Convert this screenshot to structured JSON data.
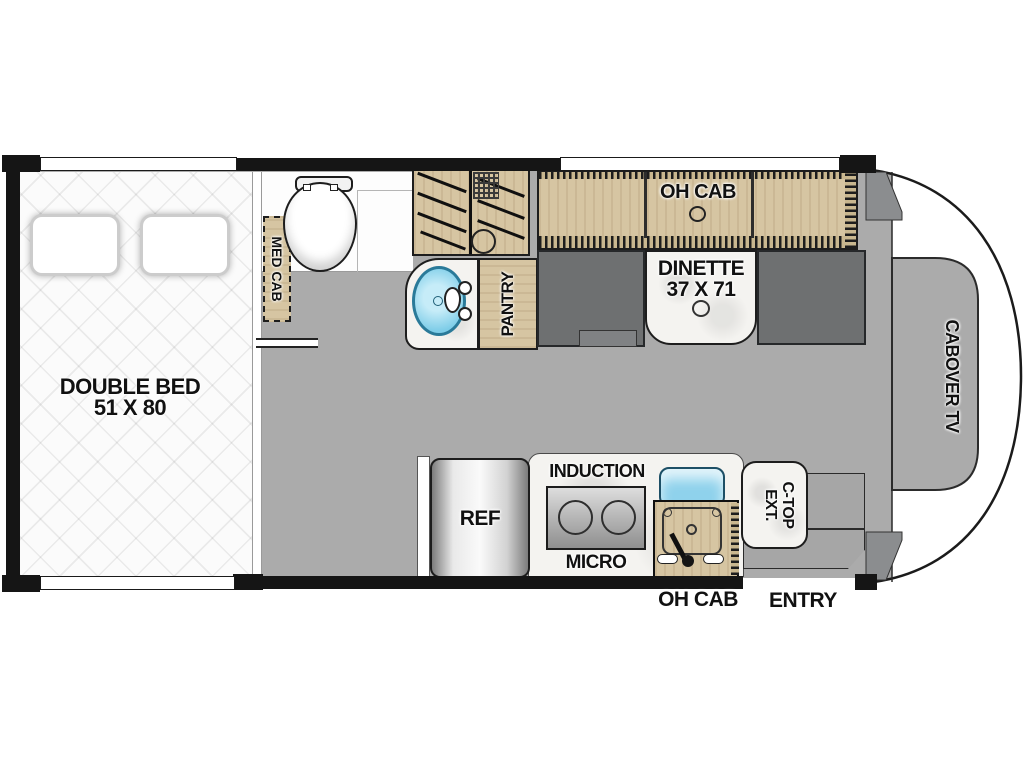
{
  "labels": {
    "double_bed_line1": "DOUBLE BED",
    "double_bed_line2": "51 X 80",
    "med_cab": "MED CAB",
    "pantry": "PANTRY",
    "oh_cab_top": "OH CAB",
    "dinette_line1": "DINETTE",
    "dinette_line2": "37 X 71",
    "cabover_tv": "CABOVER TV",
    "ref": "REF",
    "induction": "INDUCTION",
    "micro": "MICRO",
    "oh_cab_bottom": "OH CAB",
    "ctop_line1": "C-TOP",
    "ctop_line2": "EXT.",
    "entry": "ENTRY"
  },
  "colors": {
    "wall": "#151515",
    "floor": "#ababab",
    "wood_cabinet": "#d6c5a2",
    "bench_gray": "#6e7071",
    "sink_blue": "#7ecde8",
    "kitchen_sink_blue": "#8fd2ec",
    "counter_marble": "#f4f3f0",
    "bed_white": "#fbfbfb"
  }
}
